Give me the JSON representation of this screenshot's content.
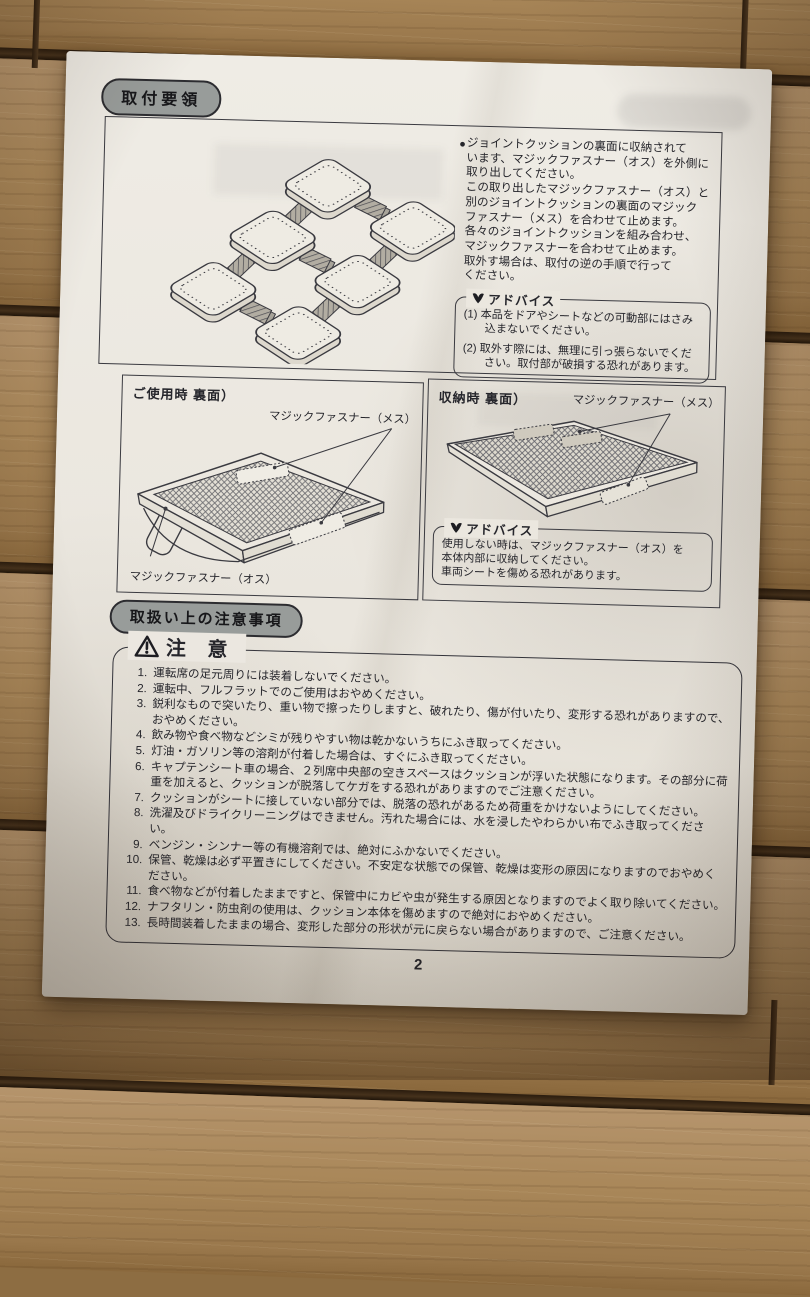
{
  "page_number": "2",
  "colors": {
    "paper": "#ebe7df",
    "ink": "#26262c",
    "pill_fill": "#989c9a",
    "wood": "#a98759"
  },
  "install": {
    "title": "取付要領",
    "bullet": "●",
    "body": "ジョイントクッションの裏面に収納されて\nいます、マジックファスナー（オス）を外側に\n取り出してください。\nこの取り出したマジックファスナー（オス）と\n別のジョイントクッションの裏面のマジック\nファスナー（メス）を合わせて止めます。\n各々のジョイントクッションを組み合わせ、\nマジックファスナーを合わせて止めます。\n取外す場合は、取付の逆の手順で行って\nください。",
    "advice_title": "アドバイス",
    "advice_items": [
      "(1) 本品をドアやシートなどの可動部にはさみ込まないでください。",
      "(2) 取外す際には、無理に引っ張らないでください。取付部が破損する恐れがあります。"
    ]
  },
  "use_diagram": {
    "title": "ご使用時 裏面）",
    "label_female": "マジックファスナー（メス）",
    "label_male": "マジックファスナー（オス）"
  },
  "storage_diagram": {
    "title": "収納時 裏面）",
    "label_female": "マジックファスナー（メス）",
    "advice_title": "アドバイス",
    "advice_body": "使用しない時は、マジックファスナー（オス）を\n本体内部に収納してください。\n車両シートを傷める恐れがあります。"
  },
  "precautions": {
    "title": "取扱い上の注意事項",
    "caution_title": "注 意",
    "items": [
      {
        "num": "1.",
        "text": "運転席の足元周りには装着しないでください。"
      },
      {
        "num": "2.",
        "text": "運転中、フルフラットでのご使用はおやめください。"
      },
      {
        "num": "3.",
        "text": "鋭利なもので突いたり、重い物で擦ったりしますと、破れたり、傷が付いたり、変形する恐れがありますので、おやめください。"
      },
      {
        "num": "4.",
        "text": "飲み物や食べ物などシミが残りやすい物は乾かないうちにふき取ってください。"
      },
      {
        "num": "5.",
        "text": "灯油・ガソリン等の溶剤が付着した場合は、すぐにふき取ってください。"
      },
      {
        "num": "6.",
        "text": "キャプテンシート車の場合、２列席中央部の空きスペースはクッションが浮いた状態になります。その部分に荷重を加えると、クッションが脱落してケガをする恐れがありますのでご注意ください。"
      },
      {
        "num": "7.",
        "text": "クッションがシートに接していない部分では、脱落の恐れがあるため荷重をかけないようにしてください。"
      },
      {
        "num": "8.",
        "text": "洗濯及びドライクリーニングはできません。汚れた場合には、水を浸したやわらかい布でふき取ってください。"
      },
      {
        "num": "9.",
        "text": "ベンジン・シンナー等の有機溶剤では、絶対にふかないでください。"
      },
      {
        "num": "10.",
        "text": "保管、乾燥は必ず平置きにしてください。不安定な状態での保管、乾燥は変形の原因になりますのでおやめください。"
      },
      {
        "num": "11.",
        "text": "食べ物などが付着したままですと、保管中にカビや虫が発生する原因となりますのでよく取り除いてください。"
      },
      {
        "num": "12.",
        "text": "ナフタリン・防虫剤の使用は、クッション本体を傷めますので絶対におやめください。"
      },
      {
        "num": "13.",
        "text": "長時間装着したままの場合、変形した部分の形状が元に戻らない場合がありますので、ご注意ください。"
      }
    ]
  }
}
